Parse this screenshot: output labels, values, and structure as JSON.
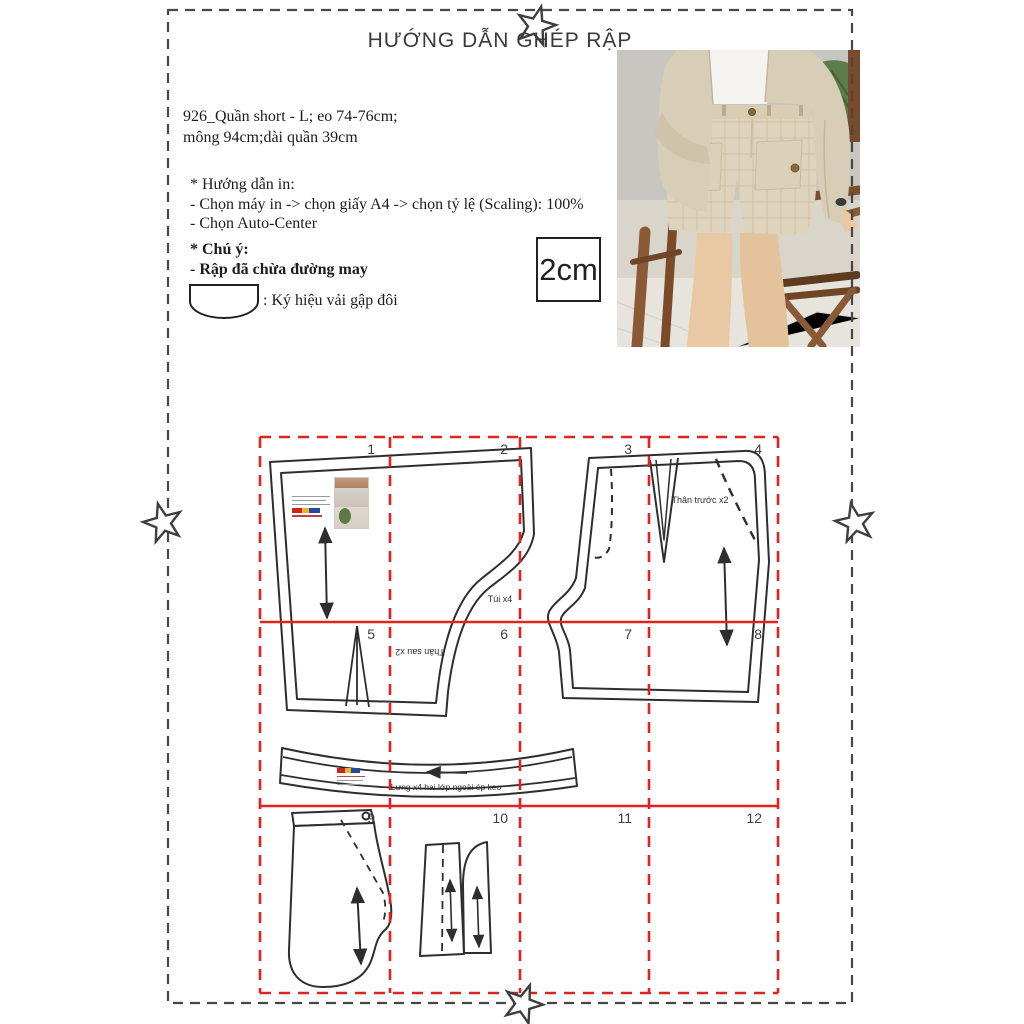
{
  "page": {
    "title": "HƯỚNG DẪN GHÉP RẬP",
    "product_info": {
      "line1": "926_Quần short - L; eo 74-76cm;",
      "line2": "mông 94cm;dài quần 39cm"
    },
    "print_instructions": {
      "heading": "* Hướng dẫn in:",
      "step1": "- Chọn máy in -> chọn giấy A4  -> chọn tỷ lệ (Scaling): 100%",
      "step2": "- Chọn Auto-Center"
    },
    "notes": {
      "heading": "* Chú ý:",
      "line1": "- Rập đã chừa đường may"
    },
    "fold_symbol_label": ": Ký hiệu vải gập đôi",
    "scale_box_label": "2cm"
  },
  "grid": {
    "page_numbers": [
      "1",
      "2",
      "3",
      "4",
      "5",
      "6",
      "7",
      "8",
      "9",
      "10",
      "11",
      "12"
    ],
    "line_color": "#df241f"
  },
  "pattern_labels": {
    "back_piece": "Thân sau x2",
    "pocket": "Túi x4",
    "front_piece": "Thân trước x2",
    "waistband": "Lưng x4 hai lớp ngoài ép keo"
  },
  "colors": {
    "grid_red": "#df241f",
    "outline_black": "#2e2e2e",
    "border_gray": "#474747"
  }
}
